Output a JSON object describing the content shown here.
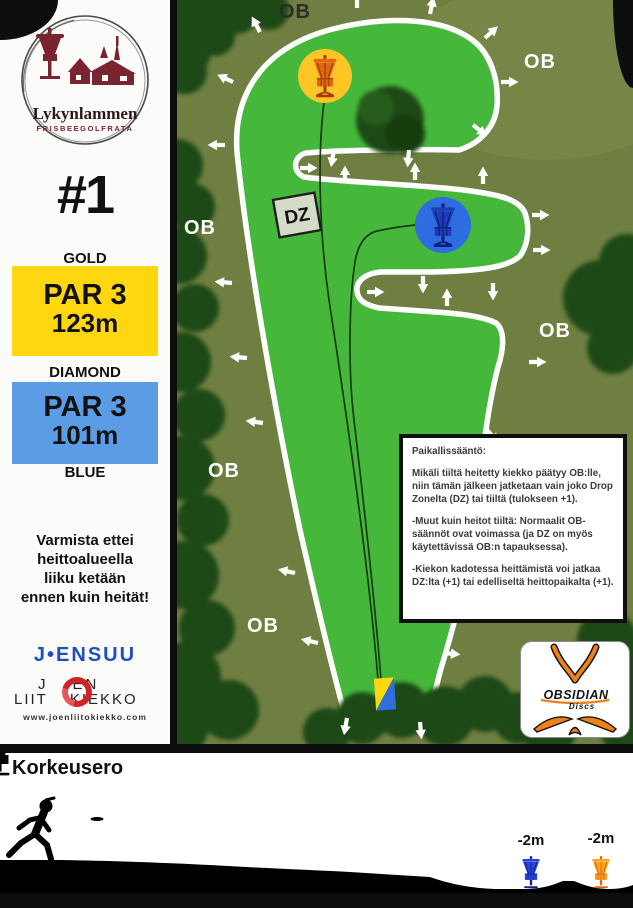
{
  "sidebar": {
    "logo": {
      "title": "Lykynlammen",
      "subtitle": "FRISBEEGOLFRATA"
    },
    "hole_number": "#1",
    "tees": [
      {
        "tier": "GOLD",
        "par": "PAR 3",
        "distance": "123m",
        "color": "#fed711"
      },
      {
        "tier": "DIAMOND",
        "par": "PAR 3",
        "distance": "101m",
        "footer": "BLUE",
        "color": "#5b9ce5"
      }
    ],
    "warning": "Varmista ettei heittoalueella liiku ketään ennen kuin heität!",
    "sponsors": {
      "city": "J•ENSUU",
      "club_top_left": "J",
      "club_top_right": "EN",
      "club_bottom_left": "LIIT",
      "club_bottom_right": "KIEKKO",
      "club_url": "www.joenliitokiekko.com"
    }
  },
  "map": {
    "ob_labels": [
      "OB",
      "OB",
      "OB",
      "OB",
      "OB",
      "OB"
    ],
    "dz_label": "DZ",
    "colors": {
      "fairway": "#45b83c",
      "rough": "#6f7f41",
      "border": "#ffffff",
      "gold_basket_circle": "#fec526",
      "blue_basket_circle": "#2e6ce2",
      "tee_yellow": "#ffd711",
      "tee_blue": "#2e6fe0"
    }
  },
  "rules": {
    "title": "Paikallissääntö:",
    "paragraphs": [
      "Mikäli tiiltä heitetty kiekko päätyy OB:lle, niin tämän jälkeen jatketaan vain joko Drop Zonelta (DZ) tai tiiltä (tulokseen +1).",
      "-Muut kuin heitot tiiltä: Normaalit OB-säännöt ovat voimassa (ja DZ on myös käytettävissä OB:n tapauksessa).",
      "-Kiekon kadotessa heittämistä voi jatkaa DZ:lta (+1) tai edelliseltä heittopaikalta (+1)."
    ]
  },
  "obsidian": {
    "name": "OBSIDIAN",
    "sub": "Discs"
  },
  "elevation": {
    "title": "Korkeusero",
    "markers": [
      {
        "label": "-2m",
        "color": "#2945d6"
      },
      {
        "label": "-2m",
        "color": "#f7a41c"
      }
    ]
  }
}
